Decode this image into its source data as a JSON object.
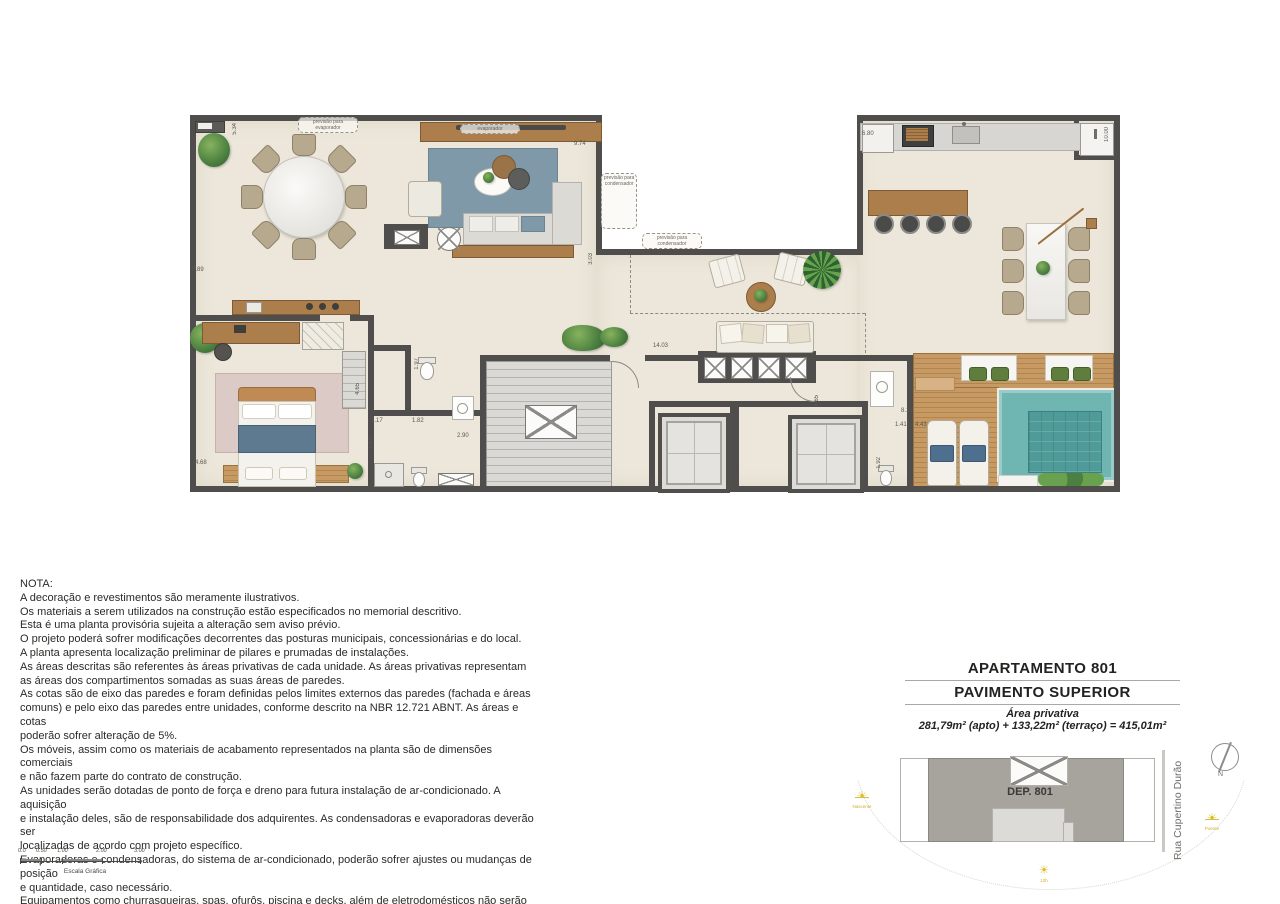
{
  "title_block": {
    "line1": "APARTAMENTO 801",
    "line2": "PAVIMENTO SUPERIOR",
    "area_label": "Área privativa",
    "area_value": "281,79m² (apto) + 133,22m² (terraço) = 415,01m²"
  },
  "nota": {
    "title": "NOTA:",
    "body": "A decoração e revestimentos são meramente ilustrativos.\nOs materiais a serem utilizados na construção estão especificados no memorial descritivo.\nEsta é uma planta provisória sujeita a alteração sem aviso prévio.\nO projeto poderá sofrer modificações decorrentes das posturas municipais, concessionárias e do local.\nA planta apresenta localização preliminar de pilares e prumadas de instalações.\nAs áreas descritas são referentes às áreas privativas de cada unidade. As áreas privativas representam\nas áreas dos compartimentos somadas as suas áreas de paredes.\nAs cotas são de eixo das paredes e foram definidas pelos limites externos das paredes (fachada e áreas\ncomuns) e pelo eixo das paredes entre unidades, conforme descrito na NBR 12.721 ABNT. As áreas e cotas\npoderão sofrer alteração de 5%.\nOs móveis, assim como os materiais de acabamento representados na planta são de dimensões comerciais\ne não fazem parte do contrato de construção.\nAs unidades serão dotadas de ponto de força e dreno para futura instalação de ar-condicionado. A aquisição\ne instalação deles, são de responsabilidade dos adquirentes. As condensadoras e evaporadoras deverão ser\nlocalizadas de acordo com projeto específico.\nEvaporadoras e condensadoras, do sistema de ar-condicionado, poderão sofrer ajustes ou mudanças de posição\ne quantidade, caso necessário.\nEquipamentos como churrasqueiras, spas, ofurôs, piscina e decks, além de eletrodomésticos não serão entregues,\napenas sua infra estrutura."
  },
  "scale_bar": {
    "ticks": [
      "0.0",
      "0.50",
      "1.00",
      "2.00",
      "3.00"
    ],
    "caption": "Escala Gráfica"
  },
  "keyplan": {
    "unit": "DEP. 801",
    "street": "Rua Cupertino Durão",
    "north": "N",
    "sun_rise": "Nascente",
    "sun_noon": "12h",
    "sun_set": "Poente"
  },
  "plan": {
    "annotations": {
      "previsao_evaporador": "previsão para\nevaporador",
      "evaporador": "evaporador",
      "previsao_condensador": "previsão para\ncondensador"
    },
    "dims": {
      "d534": "5.34",
      "d974": "9.74",
      "d303": "3.03",
      "d089": "0.89",
      "d468": "4.68",
      "d680": "6.80",
      "d1000": "10.00",
      "d1403": "14.03",
      "d465a": "4.65",
      "d197": "1.97",
      "d117": "1.17",
      "d182": "1.82",
      "d160": "1.60",
      "d290": "2.90",
      "d465b": "4.65",
      "d811": "8.11",
      "d141": "1.41",
      "d443": "4.43",
      "d192": "1.92"
    },
    "colors": {
      "wall": "#4f4e4c",
      "floor": "#ece7da",
      "wood": "#ac7e4b",
      "deck": "#c1945f",
      "pool": "#6fb5b2",
      "pool_inner": "#4f9b99",
      "rug": "#8099a8",
      "stair": "#d9d8d4",
      "keyplan_building": "#a7a39d",
      "sun": "#dcbe2b"
    }
  }
}
